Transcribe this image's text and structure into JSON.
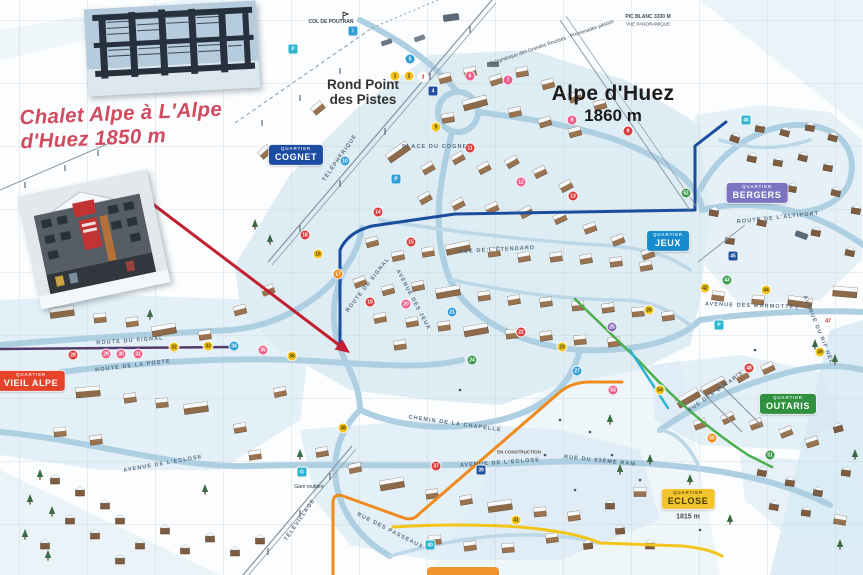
{
  "annotation": {
    "line1": "Chalet Alpe à L'Alpe",
    "line2": "d'Huez 1850 m",
    "color": "#d14b5e"
  },
  "labels": {
    "rond_point_line1": "Rond Point",
    "rond_point_line2": "des Pistes",
    "resort_name": "Alpe d'Huez",
    "resort_altitude": "1860 m",
    "col_de_poutran": "COL DE POUTRAN",
    "pic_blanc": "PIC BLANC 3330 M",
    "pic_blanc_sub": "VUE PANORAMIQUE",
    "telepherique_note": "Téléphérique des Grandes Rousses - Promenades piétons",
    "en_construction": "EN CONSTRUCTION",
    "gare_routiere": "Gare routière",
    "eclose_altitude": "1815 m"
  },
  "quartiers": [
    {
      "id": "cognet",
      "small": "QUARTIER",
      "name": "COGNET",
      "bg": "#1d4da2",
      "fg": "#ffffff",
      "x": 296,
      "y": 155
    },
    {
      "id": "bergers",
      "small": "QUARTIER",
      "name": "BERGERS",
      "bg": "#7c74c3",
      "fg": "#ffffff",
      "x": 757,
      "y": 193
    },
    {
      "id": "jeux",
      "small": "QUARTIER",
      "name": "JEUX",
      "bg": "#178ccd",
      "fg": "#ffffff",
      "x": 668,
      "y": 241
    },
    {
      "id": "vieil-alpe",
      "small": "QUARTIER",
      "name": "VIEIL ALPE",
      "bg": "#e6432b",
      "fg": "#ffffff",
      "x": 31,
      "y": 381
    },
    {
      "id": "outaris",
      "small": "QUARTIER",
      "name": "OUTARIS",
      "bg": "#2f9140",
      "fg": "#ffffff",
      "x": 788,
      "y": 404
    },
    {
      "id": "eclose",
      "small": "QUARTIER",
      "name": "ECLOSE",
      "bg": "#f2c52e",
      "fg": "#453a00",
      "x": 688,
      "y": 499
    }
  ],
  "road_labels": [
    {
      "text": "ROUTE DU SIGNAL",
      "x": 130,
      "y": 341,
      "r": -4
    },
    {
      "text": "ROUTE DU SIGNAL",
      "x": 368,
      "y": 285,
      "r": -52
    },
    {
      "text": "ROUTE DE LA POSTE",
      "x": 133,
      "y": 366,
      "r": -7
    },
    {
      "text": "AVENUE DE L'ECLOSE",
      "x": 163,
      "y": 464,
      "r": -10
    },
    {
      "text": "AVENUE DE L'ECLOSE",
      "x": 500,
      "y": 463,
      "r": -4
    },
    {
      "text": "RUE DU 93ÈME RAM",
      "x": 600,
      "y": 461,
      "r": 6
    },
    {
      "text": "RUE DES PASSEAUX",
      "x": 390,
      "y": 531,
      "r": 27
    },
    {
      "text": "AVENUE DES MARMOTTES",
      "x": 752,
      "y": 306,
      "r": 2
    },
    {
      "text": "AVENUE DU RIF NEL",
      "x": 818,
      "y": 330,
      "r": 68
    },
    {
      "text": "ROUTE DE L'ALTIPORT",
      "x": 778,
      "y": 218,
      "r": -6
    },
    {
      "text": "RUE DES OUTARIS",
      "x": 716,
      "y": 392,
      "r": -35
    },
    {
      "text": "CHEMIN DE LA CHAPELLE",
      "x": 455,
      "y": 424,
      "r": 8
    },
    {
      "text": "AVENUE DES JEUX",
      "x": 413,
      "y": 300,
      "r": 62
    },
    {
      "text": "RUE DE L'ETENDARD",
      "x": 497,
      "y": 250,
      "r": -3
    },
    {
      "text": "PLACE DU COGNET",
      "x": 437,
      "y": 147,
      "r": 0
    },
    {
      "text": "TÉLÉPHÉRIQUE",
      "x": 340,
      "y": 158,
      "r": -55
    },
    {
      "text": "TÉLÉVILLAGE",
      "x": 300,
      "y": 520,
      "r": -55
    }
  ],
  "marker_colors": {
    "Y": {
      "bg": "#f2c51d",
      "fg": "#4a3b00"
    },
    "P": {
      "bg": "#ec5f8a",
      "fg": "#ffffff"
    },
    "R": {
      "bg": "#d93a3a",
      "fg": "#ffffff"
    },
    "B": {
      "bg": "#2f9fd8",
      "fg": "#ffffff"
    },
    "N": {
      "bg": "#1d4fa1",
      "fg": "#ffffff"
    },
    "G": {
      "bg": "#3a9a4a",
      "fg": "#ffffff"
    },
    "V": {
      "bg": "#8b6bb8",
      "fg": "#ffffff"
    },
    "O": {
      "bg": "#ef8b1d",
      "fg": "#ffffff"
    },
    "C": {
      "bg": "#29b5d0",
      "fg": "#ffffff"
    },
    "W": {
      "bg": "#ffffff",
      "fg": "#c22"
    }
  },
  "markers": [
    [
      395,
      76,
      "Y",
      "1"
    ],
    [
      409,
      76,
      "Y",
      "2"
    ],
    [
      423,
      77,
      "W",
      "3"
    ],
    [
      433,
      91,
      "N",
      "4",
      "s"
    ],
    [
      293,
      49,
      "C",
      "P",
      "s"
    ],
    [
      353,
      31,
      "B",
      "i",
      "s"
    ],
    [
      410,
      59,
      "B",
      "5"
    ],
    [
      470,
      76,
      "P",
      "6"
    ],
    [
      508,
      80,
      "P",
      "7"
    ],
    [
      572,
      120,
      "P",
      "8"
    ],
    [
      628,
      131,
      "R",
      "9"
    ],
    [
      436,
      127,
      "Y",
      "9"
    ],
    [
      345,
      161,
      "B",
      "10"
    ],
    [
      470,
      148,
      "R",
      "11"
    ],
    [
      521,
      182,
      "P",
      "12"
    ],
    [
      573,
      196,
      "R",
      "13"
    ],
    [
      378,
      212,
      "R",
      "14"
    ],
    [
      411,
      242,
      "R",
      "15"
    ],
    [
      318,
      254,
      "Y",
      "16"
    ],
    [
      338,
      274,
      "O",
      "17"
    ],
    [
      305,
      235,
      "R",
      "18"
    ],
    [
      396,
      179,
      "B",
      "P",
      "s"
    ],
    [
      370,
      302,
      "R",
      "19"
    ],
    [
      406,
      304,
      "P",
      "20"
    ],
    [
      452,
      312,
      "B",
      "21"
    ],
    [
      521,
      332,
      "R",
      "22"
    ],
    [
      562,
      347,
      "Y",
      "23"
    ],
    [
      472,
      360,
      "G",
      "24"
    ],
    [
      612,
      327,
      "V",
      "25"
    ],
    [
      649,
      310,
      "Y",
      "26"
    ],
    [
      577,
      371,
      "B",
      "27"
    ],
    [
      73,
      355,
      "R",
      "28"
    ],
    [
      106,
      354,
      "P",
      "29"
    ],
    [
      121,
      354,
      "P",
      "30"
    ],
    [
      138,
      354,
      "P",
      "31"
    ],
    [
      174,
      347,
      "Y",
      "32"
    ],
    [
      208,
      346,
      "Y",
      "33"
    ],
    [
      234,
      346,
      "B",
      "34"
    ],
    [
      263,
      350,
      "P",
      "35"
    ],
    [
      292,
      356,
      "Y",
      "36"
    ],
    [
      436,
      466,
      "R",
      "37"
    ],
    [
      343,
      428,
      "Y",
      "38"
    ],
    [
      481,
      470,
      "N",
      "39",
      "s"
    ],
    [
      430,
      545,
      "C",
      "40",
      "s"
    ],
    [
      302,
      472,
      "C",
      "G",
      "s"
    ],
    [
      516,
      520,
      "Y",
      "41"
    ],
    [
      705,
      288,
      "Y",
      "42"
    ],
    [
      727,
      280,
      "G",
      "43"
    ],
    [
      766,
      290,
      "Y",
      "44"
    ],
    [
      733,
      256,
      "N",
      "45",
      "s"
    ],
    [
      746,
      120,
      "C",
      "46",
      "s"
    ],
    [
      828,
      321,
      "W",
      "47"
    ],
    [
      749,
      368,
      "R",
      "48"
    ],
    [
      820,
      352,
      "Y",
      "49"
    ],
    [
      712,
      438,
      "O",
      "50"
    ],
    [
      770,
      455,
      "G",
      "51"
    ],
    [
      686,
      193,
      "G",
      "52"
    ],
    [
      613,
      390,
      "P",
      "53"
    ],
    [
      660,
      390,
      "Y",
      "54"
    ],
    [
      719,
      325,
      "C",
      "P",
      "s"
    ]
  ],
  "decor": {
    "buildings": [
      [
        445,
        78,
        -15,
        0
      ],
      [
        470,
        72,
        -12,
        0
      ],
      [
        496,
        80,
        -18,
        0
      ],
      [
        522,
        72,
        -10,
        0
      ],
      [
        548,
        84,
        -15,
        0
      ],
      [
        575,
        97,
        -20,
        0
      ],
      [
        600,
        105,
        -15,
        0
      ],
      [
        475,
        103,
        -15,
        1
      ],
      [
        515,
        112,
        -12,
        0
      ],
      [
        545,
        122,
        -18,
        0
      ],
      [
        575,
        132,
        -15,
        0
      ],
      [
        448,
        118,
        -10,
        0
      ],
      [
        398,
        152,
        -35,
        1
      ],
      [
        428,
        168,
        -30,
        0
      ],
      [
        458,
        158,
        -30,
        0
      ],
      [
        484,
        168,
        -28,
        0
      ],
      [
        512,
        162,
        -30,
        0
      ],
      [
        540,
        172,
        -25,
        0
      ],
      [
        566,
        186,
        -28,
        0
      ],
      [
        425,
        198,
        -30,
        0
      ],
      [
        458,
        204,
        -28,
        0
      ],
      [
        492,
        208,
        -25,
        0
      ],
      [
        526,
        212,
        -28,
        0
      ],
      [
        560,
        218,
        -25,
        0
      ],
      [
        590,
        228,
        -20,
        0
      ],
      [
        618,
        240,
        -22,
        0
      ],
      [
        648,
        254,
        -20,
        0
      ],
      [
        265,
        152,
        -42,
        0
      ],
      [
        318,
        108,
        -40,
        0
      ],
      [
        372,
        242,
        -15,
        0
      ],
      [
        398,
        256,
        -12,
        0
      ],
      [
        428,
        252,
        -10,
        0
      ],
      [
        458,
        248,
        -12,
        1
      ],
      [
        494,
        252,
        -8,
        0
      ],
      [
        524,
        257,
        -10,
        0
      ],
      [
        556,
        257,
        -8,
        0
      ],
      [
        586,
        259,
        -10,
        0
      ],
      [
        616,
        262,
        -8,
        0
      ],
      [
        646,
        266,
        -10,
        0
      ],
      [
        360,
        282,
        -20,
        0
      ],
      [
        388,
        290,
        -15,
        0
      ],
      [
        418,
        286,
        -12,
        0
      ],
      [
        448,
        292,
        -10,
        1
      ],
      [
        484,
        296,
        -8,
        0
      ],
      [
        514,
        300,
        -10,
        0
      ],
      [
        546,
        302,
        -8,
        0
      ],
      [
        578,
        306,
        -6,
        0
      ],
      [
        608,
        308,
        -8,
        0
      ],
      [
        638,
        312,
        -6,
        0
      ],
      [
        668,
        316,
        -8,
        0
      ],
      [
        380,
        318,
        -12,
        0
      ],
      [
        412,
        322,
        -10,
        0
      ],
      [
        444,
        326,
        -8,
        0
      ],
      [
        476,
        330,
        -10,
        1
      ],
      [
        512,
        334,
        -6,
        0
      ],
      [
        546,
        336,
        -8,
        0
      ],
      [
        580,
        340,
        -6,
        0
      ],
      [
        614,
        342,
        -8,
        0
      ],
      [
        400,
        345,
        -8,
        0
      ],
      [
        62,
        312,
        -8,
        1
      ],
      [
        100,
        318,
        -6,
        0
      ],
      [
        132,
        322,
        -8,
        0
      ],
      [
        164,
        330,
        -10,
        1
      ],
      [
        205,
        335,
        -8,
        0
      ],
      [
        240,
        310,
        -15,
        0
      ],
      [
        268,
        290,
        -20,
        0
      ],
      [
        88,
        392,
        -5,
        1
      ],
      [
        130,
        398,
        -8,
        0
      ],
      [
        162,
        403,
        -6,
        0
      ],
      [
        196,
        408,
        -8,
        1
      ],
      [
        240,
        428,
        -10,
        0
      ],
      [
        60,
        432,
        -5,
        0
      ],
      [
        96,
        440,
        -8,
        0
      ],
      [
        280,
        392,
        -12,
        0
      ],
      [
        255,
        455,
        -8,
        0
      ],
      [
        55,
        480,
        0,
        2
      ],
      [
        80,
        492,
        0,
        2
      ],
      [
        105,
        505,
        0,
        2
      ],
      [
        70,
        520,
        0,
        2
      ],
      [
        95,
        535,
        0,
        2
      ],
      [
        120,
        520,
        0,
        2
      ],
      [
        45,
        545,
        0,
        2
      ],
      [
        140,
        545,
        0,
        2
      ],
      [
        165,
        530,
        0,
        2
      ],
      [
        185,
        550,
        0,
        2
      ],
      [
        210,
        538,
        0,
        2
      ],
      [
        235,
        552,
        0,
        2
      ],
      [
        260,
        540,
        0,
        2
      ],
      [
        120,
        560,
        0,
        2
      ],
      [
        322,
        452,
        -10,
        0
      ],
      [
        355,
        468,
        -12,
        0
      ],
      [
        392,
        484,
        -10,
        1
      ],
      [
        432,
        494,
        -8,
        0
      ],
      [
        466,
        500,
        -10,
        0
      ],
      [
        500,
        506,
        -8,
        1
      ],
      [
        540,
        512,
        -6,
        0
      ],
      [
        574,
        516,
        -8,
        0
      ],
      [
        435,
        540,
        -5,
        0
      ],
      [
        470,
        546,
        -8,
        0
      ],
      [
        508,
        548,
        -5,
        0
      ],
      [
        552,
        538,
        -8,
        0
      ],
      [
        588,
        545,
        -6,
        2
      ],
      [
        620,
        530,
        -5,
        2
      ],
      [
        650,
        545,
        0,
        2
      ],
      [
        610,
        505,
        0,
        2
      ],
      [
        640,
        492,
        0,
        0
      ],
      [
        735,
        138,
        20,
        2
      ],
      [
        760,
        128,
        10,
        2
      ],
      [
        785,
        132,
        15,
        2
      ],
      [
        810,
        127,
        8,
        2
      ],
      [
        833,
        137,
        15,
        2
      ],
      [
        752,
        158,
        12,
        2
      ],
      [
        778,
        162,
        10,
        2
      ],
      [
        803,
        157,
        14,
        2
      ],
      [
        828,
        167,
        10,
        2
      ],
      [
        748,
        187,
        12,
        2
      ],
      [
        792,
        188,
        10,
        2
      ],
      [
        836,
        192,
        12,
        2
      ],
      [
        714,
        212,
        10,
        2
      ],
      [
        762,
        222,
        12,
        2
      ],
      [
        816,
        232,
        10,
        2
      ],
      [
        850,
        252,
        12,
        2
      ],
      [
        856,
        210,
        10,
        2
      ],
      [
        730,
        240,
        8,
        2
      ],
      [
        845,
        292,
        5,
        1
      ],
      [
        800,
        302,
        8,
        1
      ],
      [
        758,
        300,
        5,
        0
      ],
      [
        718,
        296,
        8,
        0
      ],
      [
        688,
        398,
        -30,
        1
      ],
      [
        714,
        386,
        -28,
        1
      ],
      [
        742,
        376,
        -30,
        0
      ],
      [
        768,
        368,
        -25,
        0
      ],
      [
        700,
        424,
        -20,
        0
      ],
      [
        728,
        418,
        -25,
        0
      ],
      [
        756,
        424,
        -20,
        0
      ],
      [
        786,
        432,
        -22,
        0
      ],
      [
        812,
        442,
        -18,
        0
      ],
      [
        838,
        428,
        -15,
        2
      ],
      [
        792,
        408,
        -20,
        2
      ],
      [
        762,
        472,
        10,
        2
      ],
      [
        790,
        482,
        8,
        2
      ],
      [
        818,
        492,
        10,
        2
      ],
      [
        846,
        472,
        8,
        2
      ],
      [
        774,
        506,
        10,
        2
      ],
      [
        806,
        512,
        8,
        2
      ],
      [
        840,
        520,
        10,
        0
      ]
    ],
    "trees": [
      [
        40,
        475
      ],
      [
        30,
        500
      ],
      [
        52,
        512
      ],
      [
        25,
        535
      ],
      [
        48,
        556
      ],
      [
        205,
        490
      ],
      [
        300,
        455
      ],
      [
        620,
        470
      ],
      [
        650,
        460
      ],
      [
        700,
        500
      ],
      [
        730,
        520
      ],
      [
        840,
        545
      ],
      [
        815,
        345
      ],
      [
        835,
        360
      ],
      [
        255,
        225
      ],
      [
        270,
        240
      ],
      [
        150,
        315
      ],
      [
        690,
        480
      ],
      [
        855,
        455
      ],
      [
        610,
        420
      ]
    ]
  }
}
